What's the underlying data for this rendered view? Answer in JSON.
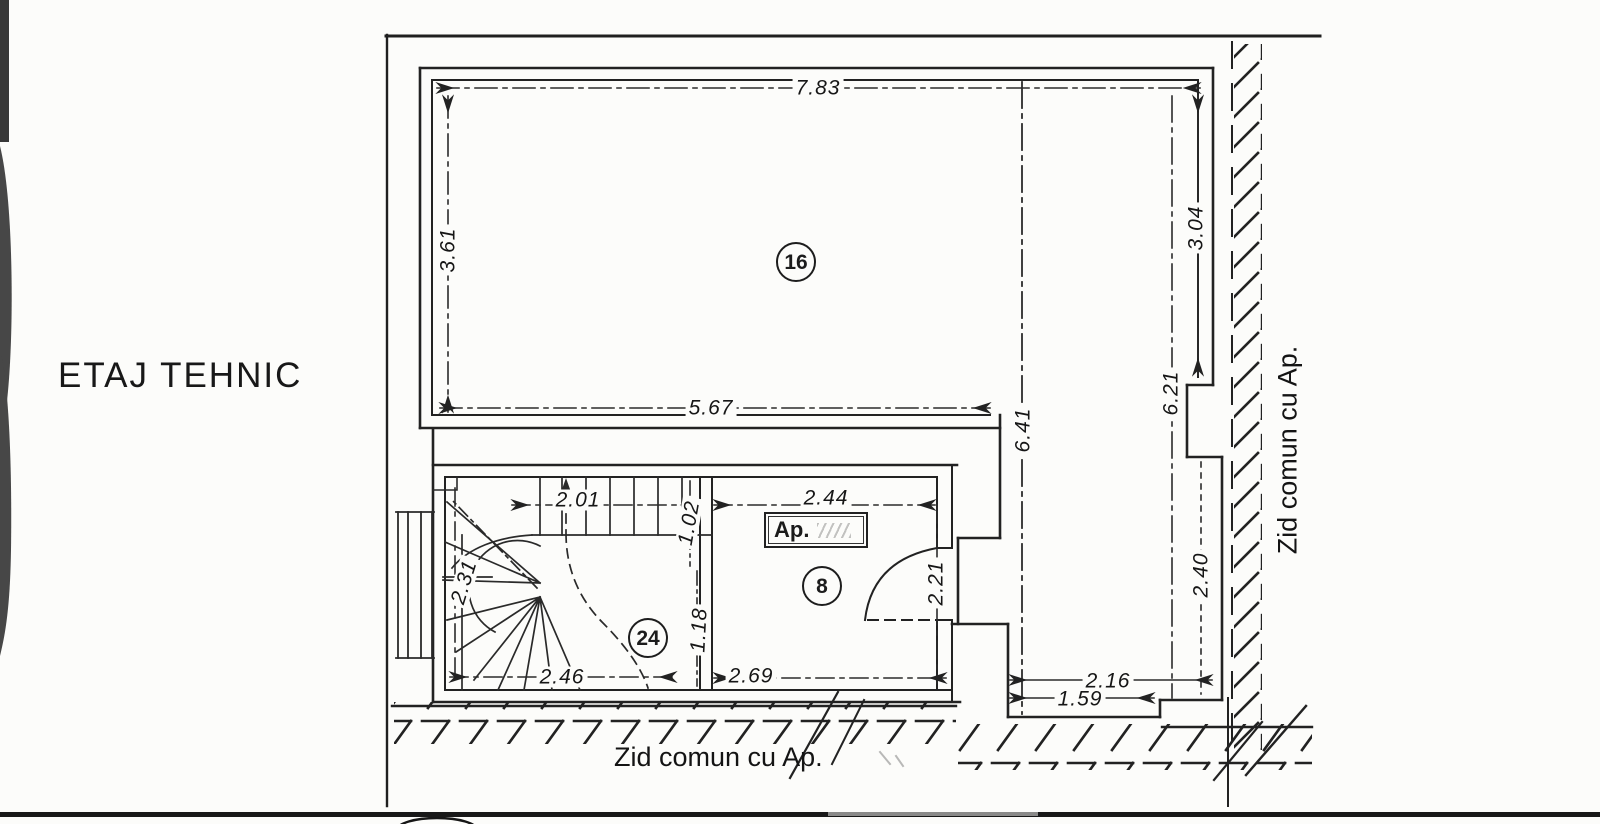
{
  "floor_plan": {
    "title": "ETAJ TEHNIC",
    "wall_labels": {
      "right": "Zid comun cu Ap.",
      "bottom": "Zid comun cu Ap."
    },
    "apartment_box": {
      "label": "Ap."
    },
    "rooms": [
      {
        "number": "16"
      },
      {
        "number": "8"
      },
      {
        "number": "24"
      }
    ],
    "dimensions_m": {
      "overall_top": "7.83",
      "room16_left_height": "3.61",
      "room16_inner_width": "5.67",
      "leg_centerline_length": "6.41",
      "right_side_length": "6.21",
      "right_upper_segment": "3.04",
      "right_lower_segment": "2.40",
      "stair_top_width": "2.01",
      "stair_upper_flight": "1.02",
      "stair_left_height": "2.31",
      "stair_bottom_width": "2.46",
      "stair_lower_flight": "1.18",
      "room8_top_width": "2.44",
      "room8_door_side": "2.21",
      "room8_bottom_width": "2.69",
      "recess_upper_width": "2.16",
      "recess_lower_width": "1.59"
    }
  }
}
